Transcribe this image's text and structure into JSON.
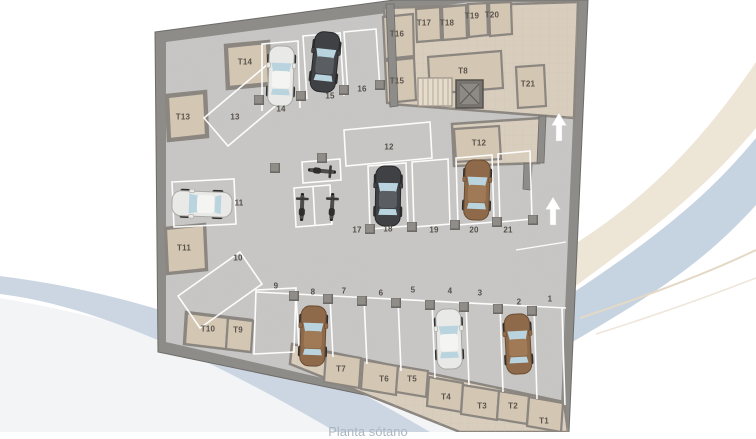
{
  "caption": "Planta sótano",
  "plan_type": "underground parking floor plan",
  "palette": {
    "wall": "#8e8c89",
    "floor": "#c8c7c5",
    "storage_floor": "#d9cebd",
    "storage_room": "#d3c6b3",
    "stall_line": "#ffffff",
    "label_color": "#55504a",
    "storage_label_color": "#5a544c",
    "car_white": "#e9e9e7",
    "car_dark": "#3f4144",
    "car_brown": "#8e6a4a",
    "window_blue": "#b9d4de",
    "swoosh_blue": "#c6d3e1",
    "swoosh_cream": "#ebe2d2",
    "arrow": "#ffffff"
  },
  "parking_spots": [
    {
      "label": "1",
      "x": 550,
      "y": 299
    },
    {
      "label": "2",
      "x": 519,
      "y": 302
    },
    {
      "label": "3",
      "x": 480,
      "y": 293
    },
    {
      "label": "4",
      "x": 450,
      "y": 291
    },
    {
      "label": "5",
      "x": 413,
      "y": 290
    },
    {
      "label": "6",
      "x": 381,
      "y": 293
    },
    {
      "label": "7",
      "x": 344,
      "y": 291
    },
    {
      "label": "8",
      "x": 313,
      "y": 292
    },
    {
      "label": "9",
      "x": 276,
      "y": 286
    },
    {
      "label": "10",
      "x": 238,
      "y": 258
    },
    {
      "label": "11",
      "x": 239,
      "y": 203
    },
    {
      "label": "12",
      "x": 389,
      "y": 147
    },
    {
      "label": "13",
      "x": 235,
      "y": 117
    },
    {
      "label": "14",
      "x": 281,
      "y": 109
    },
    {
      "label": "15",
      "x": 330,
      "y": 96
    },
    {
      "label": "16",
      "x": 362,
      "y": 89
    },
    {
      "label": "17",
      "x": 357,
      "y": 230
    },
    {
      "label": "18",
      "x": 388,
      "y": 229
    },
    {
      "label": "19",
      "x": 434,
      "y": 230
    },
    {
      "label": "20",
      "x": 474,
      "y": 230
    },
    {
      "label": "21",
      "x": 508,
      "y": 230
    }
  ],
  "storage_units": [
    {
      "label": "T1",
      "x": 544,
      "y": 421
    },
    {
      "label": "T2",
      "x": 513,
      "y": 406
    },
    {
      "label": "T3",
      "x": 482,
      "y": 406
    },
    {
      "label": "T4",
      "x": 446,
      "y": 397
    },
    {
      "label": "T5",
      "x": 412,
      "y": 379
    },
    {
      "label": "T6",
      "x": 384,
      "y": 379
    },
    {
      "label": "T7",
      "x": 341,
      "y": 369
    },
    {
      "label": "T8",
      "x": 463,
      "y": 71
    },
    {
      "label": "T9",
      "x": 238,
      "y": 330
    },
    {
      "label": "T10",
      "x": 208,
      "y": 329
    },
    {
      "label": "T11",
      "x": 184,
      "y": 248
    },
    {
      "label": "T12",
      "x": 479,
      "y": 143
    },
    {
      "label": "T13",
      "x": 183,
      "y": 117
    },
    {
      "label": "T14",
      "x": 245,
      "y": 62
    },
    {
      "label": "T15",
      "x": 397,
      "y": 81
    },
    {
      "label": "T16",
      "x": 397,
      "y": 34
    },
    {
      "label": "T17",
      "x": 424,
      "y": 23
    },
    {
      "label": "T18",
      "x": 447,
      "y": 23
    },
    {
      "label": "T19",
      "x": 472,
      "y": 16
    },
    {
      "label": "T20",
      "x": 492,
      "y": 15
    },
    {
      "label": "T21",
      "x": 528,
      "y": 84
    }
  ],
  "cars": [
    {
      "spot": "14",
      "color": "white"
    },
    {
      "spot": "15",
      "color": "dark"
    },
    {
      "spot": "11",
      "color": "white"
    },
    {
      "spot": "18",
      "color": "dark"
    },
    {
      "spot": "20",
      "color": "brown"
    },
    {
      "spot": "8",
      "color": "brown"
    },
    {
      "spot": "4",
      "color": "white"
    },
    {
      "spot": "2",
      "color": "brown"
    }
  ],
  "motorcycles_spot": "17",
  "direction_arrows_count": 2
}
